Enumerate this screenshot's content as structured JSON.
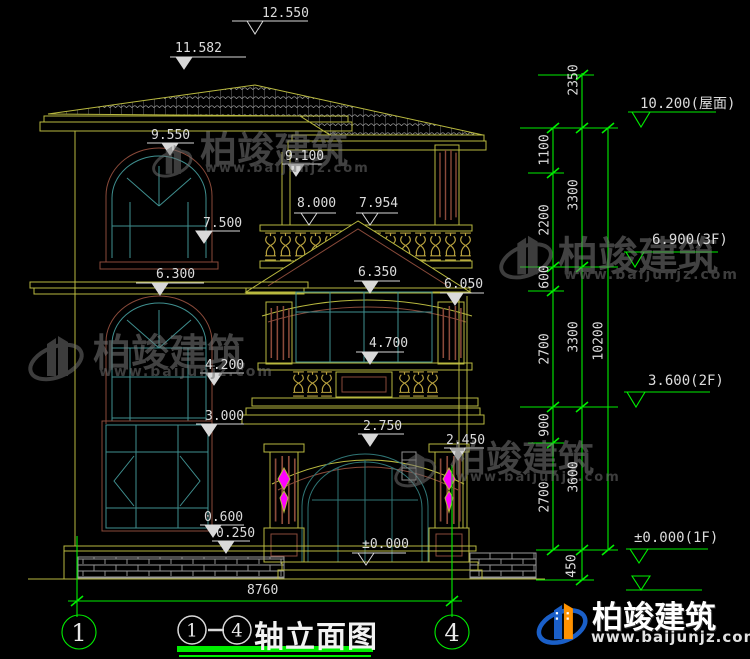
{
  "colors": {
    "background": "#000000",
    "dimension_green": "#00ee00",
    "building_yellow": "#b9b93f",
    "detail_brown": "#8a4a3a",
    "window_teal": "#3f8f8f",
    "text_white": "#dcdcdc",
    "ornament_magenta": "#ff00ff",
    "watermark_gray": "#6f6f6f",
    "logo_blue": "#1a5fc8",
    "logo_orange": "#ff9200"
  },
  "building_marks": [
    "12.550",
    "11.582",
    "9.550",
    "9.100",
    "8.000",
    "7.954",
    "7.500",
    "6.300",
    "6.350",
    "6.050",
    "4.700",
    "4.200",
    "3.000",
    "2.750",
    "2.450",
    "0.600",
    "0.250",
    "±0.000"
  ],
  "bottom_dim": "8760",
  "axes": [
    "1",
    "4"
  ],
  "right_chain_inner": [
    "1100",
    "2200",
    "600",
    "2700",
    "900",
    "2700"
  ],
  "right_chain_mid": [
    "2350",
    "3300",
    "3300",
    "3600",
    "450"
  ],
  "right_chain_total": [
    "10200"
  ],
  "level_flags": [
    "10.200(屋面)",
    "6.900(3F)",
    "3.600(2F)",
    "±0.000(1F)"
  ],
  "title": {
    "axis_start": "1",
    "axis_sep": "-",
    "axis_end": "4",
    "label": "轴立面图"
  },
  "watermark": {
    "name": "柏竣建筑",
    "site": "www.baijunjz.com"
  },
  "brand": {
    "name": "柏竣建筑",
    "site": "www.baijunjz.com"
  }
}
